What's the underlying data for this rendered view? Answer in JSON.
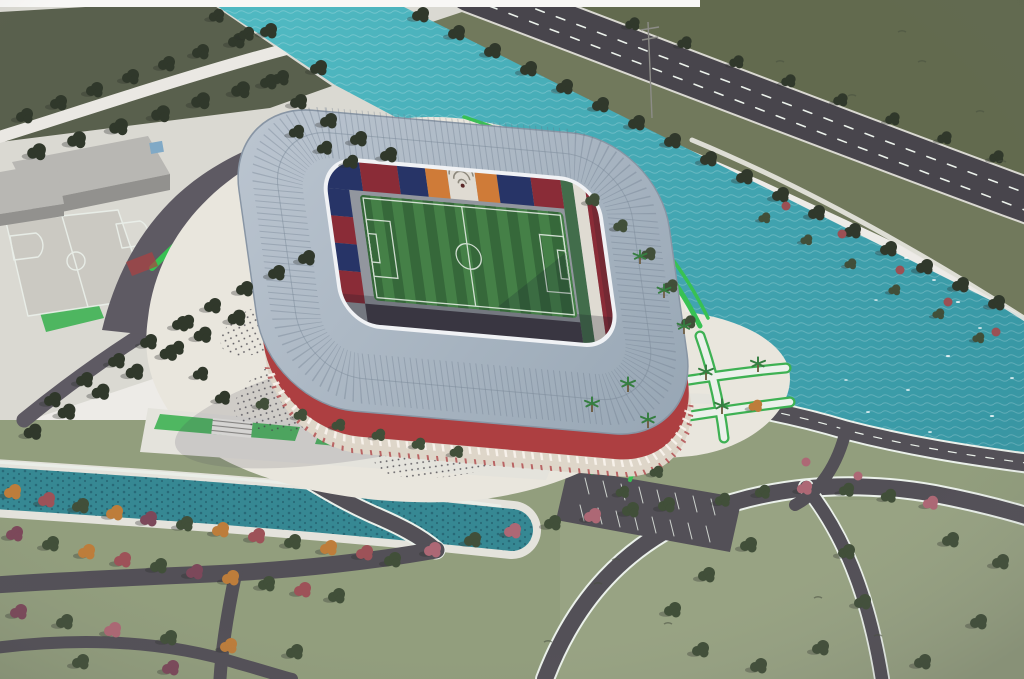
{
  "meta": {
    "description": "Aerial architectural rendering of a red-arched football stadium with a light blue-gray ring roof, striped green pitch and multicoloured stands, set on a landscaped plaza beside a turquoise river with a tree-lined highway, canal, parks and road network",
    "image_type": "photograph of a printed architectural rendering",
    "orientation": "isometric bird's-eye view"
  },
  "palette": {
    "paper": "#eceae5",
    "quay": "#d9d7d0",
    "quayPath": "#e9e7e1",
    "meadow": "#8f9c78",
    "meadowLight": "#9aa583",
    "fieldDark": "#565d48",
    "fieldOlive": "#5f6849",
    "grassStrip": "#6e7757",
    "water": "#45b8c2",
    "waterDeep": "#2e96a5",
    "canal": "#2d8793",
    "canalDark": "#1e6273",
    "roadDark": "#504d54",
    "roadMid": "#5b5761",
    "highway": "#454249",
    "plaza": "#e8e4db",
    "concrete": "#e3e1da",
    "lawn": "#33b24a",
    "arcGreen": "#2cc24a",
    "roofLight": "#b7c2ce",
    "roofDark": "#95a5b4",
    "roofEdge": "#8493a3",
    "fasciaWhite": "#eef1f4",
    "facadeRed": "#b23a3c",
    "facadeCream": "#ddd4c6",
    "apron": "#8f949c",
    "standShade": "#413d49",
    "pitch": "#3e7f40",
    "pitchStripe": "#2f6634",
    "lineWhite": "#e9f0e9",
    "seatNavy": "#223169",
    "seatMaroon": "#8e2733",
    "seatOrange": "#d3772e",
    "seatWhite": "#ded9cf",
    "seatGreen": "#3c6b46",
    "treeDark": "#2c3527",
    "treeMid": "#3d4c34",
    "treeLight": "#55663f",
    "autumnOrange": "#c07a31",
    "autumnRed": "#a04e54",
    "autumnPlum": "#7d4457",
    "blossom": "#b06472",
    "bushRed": "#9e4b50",
    "building": "#b6b5b1",
    "buildingSide": "#908f8b",
    "buildingDoor": "#7aa7c7",
    "palmTrunk": "#6b5636",
    "palmLeaf": "#2e7d3a",
    "tuft": "#454d3a",
    "crowdDot": "#3f3d45"
  },
  "stadium": {
    "roof_shape": "rounded rectangular ring",
    "seat_section_colors": [
      "navy",
      "maroon",
      "orange",
      "white",
      "green"
    ],
    "far_stand_feature": "white amphitheatre arch flanked by orange wedges",
    "east_stand_bands": [
      "green",
      "white",
      "maroon"
    ],
    "facade": "two tiers of red arches over a cream base",
    "pitch_stripe_count": 10,
    "pitch_markings": [
      "touchlines",
      "halfway line",
      "centre circle",
      "penalty areas",
      "goal areas"
    ]
  },
  "landscape": {
    "water_features": [
      "wide turquoise river wrapping the site",
      "concrete-lined canal in the south-west"
    ],
    "roads": [
      "tree-lined highway across the north-east",
      "riverside bridge road",
      "looping approach road with green median arcs",
      "southern road network with white edge lines"
    ],
    "vegetation": [
      "dark green tree rows",
      "autumn orange, red and plum trees",
      "pink blossom trees",
      "bright green lawns and hedges",
      "palm-lined walkways"
    ],
    "other": [
      "gray service building",
      "sports court with white markings",
      "terraced lawns with stairs",
      "parking lot with white stalls",
      "crowds of tiny figures on the plaza"
    ]
  }
}
